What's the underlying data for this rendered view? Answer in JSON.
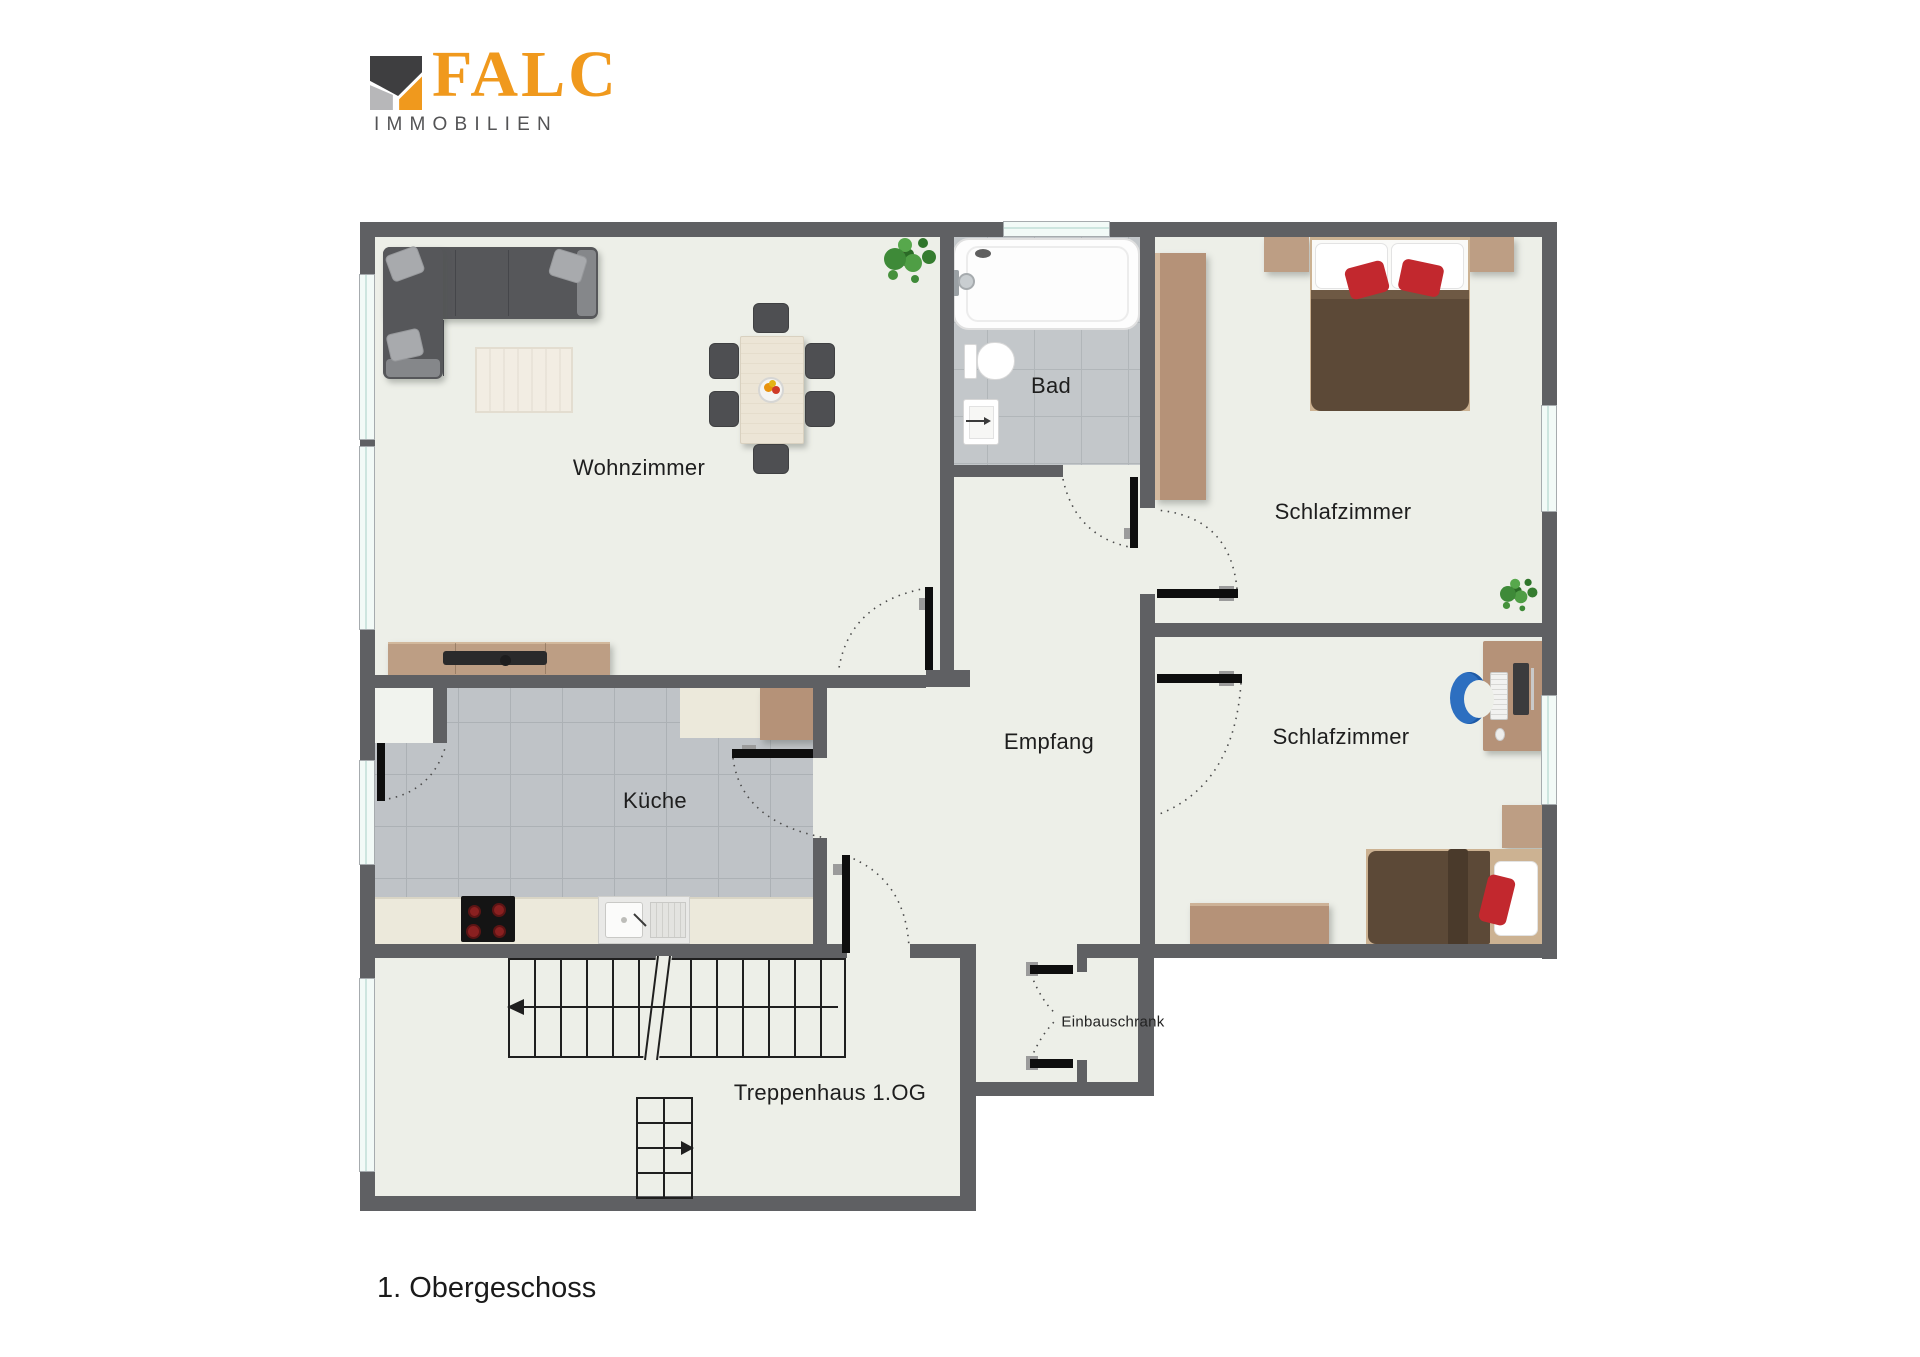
{
  "brand": {
    "name": "FALC",
    "subtitle": "IMMOBILIEN",
    "orange": "#F0991D",
    "dark_gray": "#3E3E40",
    "light_gray": "#B7B7B9"
  },
  "floor_label": "1. Obergeschoss",
  "rooms": {
    "wohnzimmer": {
      "label": "Wohnzimmer"
    },
    "bad": {
      "label": "Bad"
    },
    "schlafzimmer_oben": {
      "label": "Schlafzimmer"
    },
    "schlafzimmer_unten": {
      "label": "Schlafzimmer"
    },
    "empfang": {
      "label": "Empfang"
    },
    "kueche": {
      "label": "Küche"
    },
    "treppenhaus": {
      "label": "Treppenhaus 1.OG"
    },
    "einbauschrank": {
      "label": "Einbauschrank"
    }
  },
  "colors": {
    "wall": "#5F6063",
    "floor": "#EDEFE8",
    "tile_bath": "#C3C7CA",
    "tile_kitchen": "#BFC3C7",
    "window": "#F2FAF7",
    "wood": "#B59278",
    "sofa_gray": "#56575A",
    "duvet_brown": "#5C4937",
    "accent_red": "#C2282E",
    "counter_cream": "#ECE9DB",
    "chair_blue": "#2D6FC0",
    "plant_green": "#3E8A38"
  },
  "icons": {
    "plant_living": "potted-plant",
    "plant_bedroom": "potted-plant",
    "stairs_up_arrow": "left-arrow",
    "stairs_down_arrow": "right-arrow",
    "fruit_bowl": "fruit-bowl"
  }
}
